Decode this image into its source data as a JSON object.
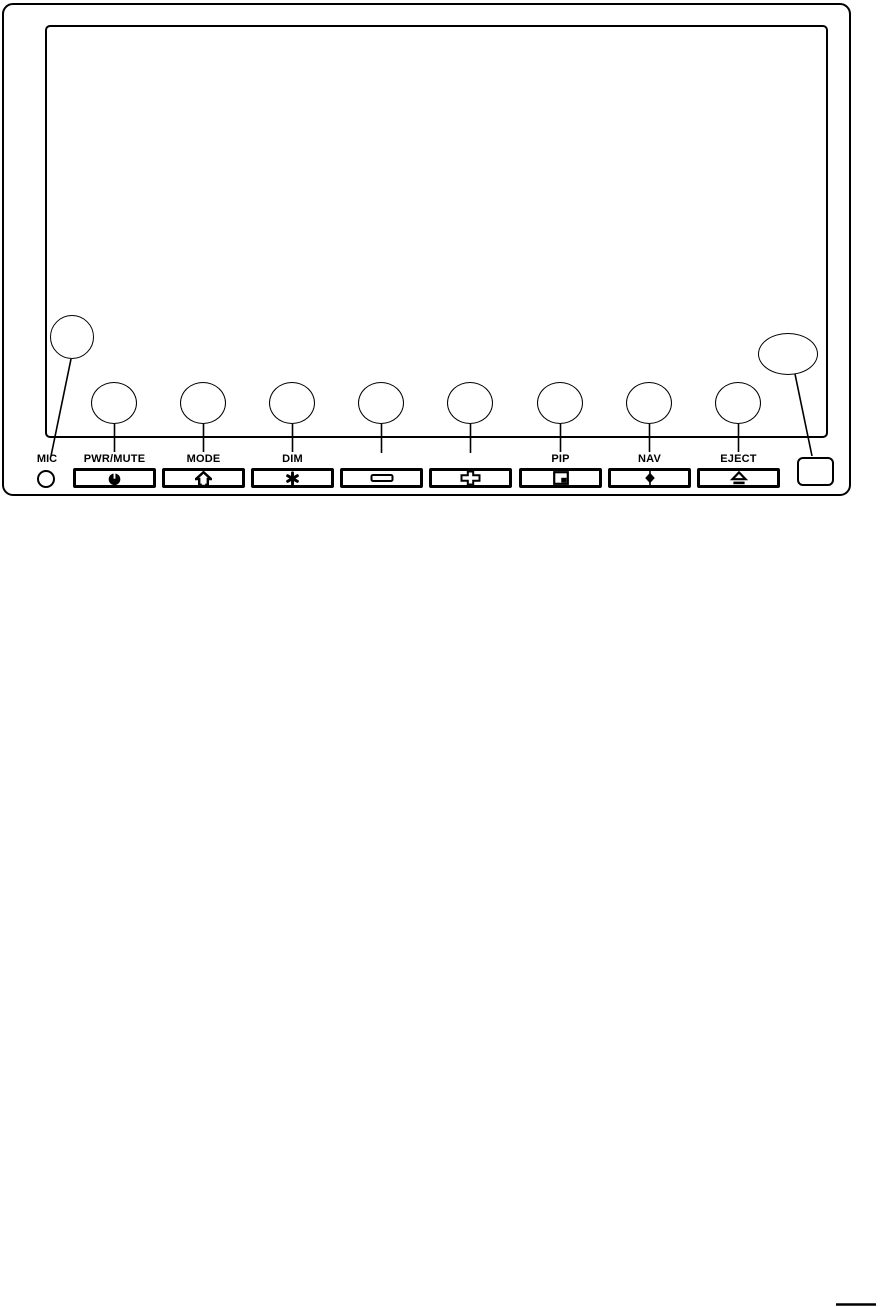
{
  "figure": {
    "kind": "head-unit-front-panel-diagram",
    "colors": {
      "line": "#000000",
      "background": "#ffffff"
    },
    "mic": {
      "label": "MIC",
      "icon": "mic-hole"
    },
    "buttons": [
      {
        "label": "PWR/MUTE",
        "icon": "power-icon"
      },
      {
        "label": "MODE",
        "icon": "home-icon"
      },
      {
        "label": "DIM",
        "icon": "brightness-icon"
      },
      {
        "label": "",
        "icon": "minus-icon"
      },
      {
        "label": "",
        "icon": "plus-icon"
      },
      {
        "label": "PIP",
        "icon": "pip-icon"
      },
      {
        "label": "NAV",
        "icon": "nav-icon"
      },
      {
        "label": "EJECT",
        "icon": "eject-icon"
      }
    ],
    "side_slot": {
      "icon": "card-slot"
    },
    "callouts": {
      "count": 10,
      "text": ""
    }
  }
}
